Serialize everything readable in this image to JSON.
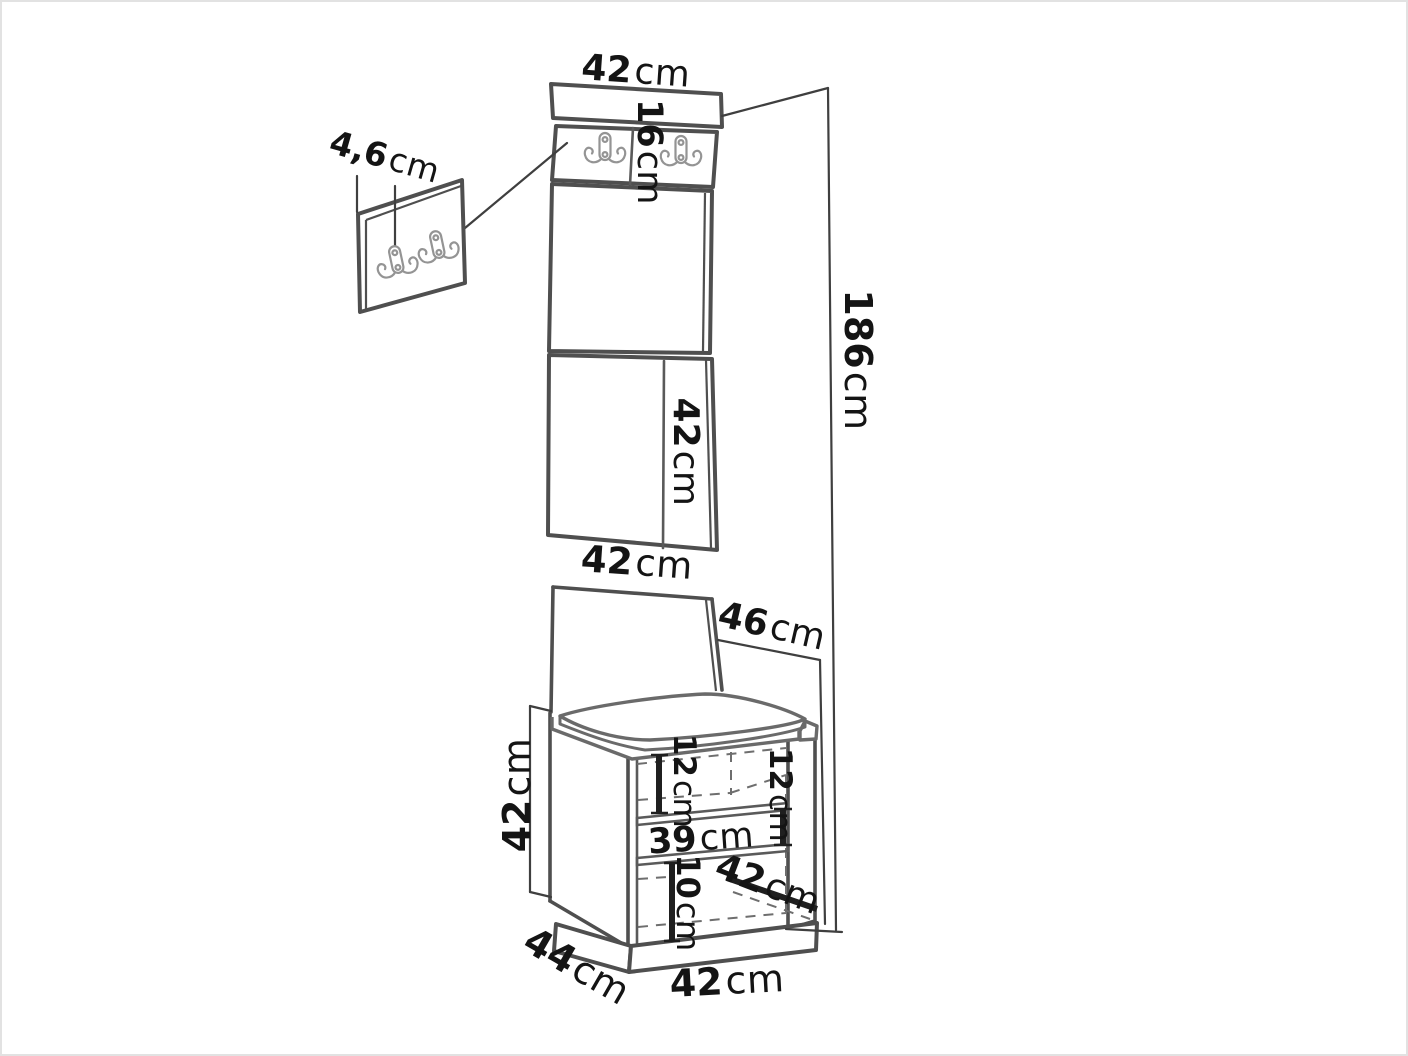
{
  "figure": {
    "kind": "furniture dimension line drawing",
    "icons": {
      "coat_hook": "double-coat-hook-icon"
    },
    "colors": {
      "background": "#ffffff",
      "line": "#4f4f4f",
      "dashed_line": "#6e6e6e",
      "hook_line": "#949494",
      "text": "#141414",
      "border": "#e2e2e2"
    }
  },
  "dimensions": {
    "top_width": {
      "value": "42",
      "unit": "cm"
    },
    "hook_strip_height": {
      "value": "16",
      "unit": "cm"
    },
    "hook_panel_thickness": {
      "value": "4,6",
      "unit": "cm"
    },
    "total_height": {
      "value": "186",
      "unit": "cm"
    },
    "panel_segment_height": {
      "value": "42",
      "unit": "cm"
    },
    "panel_width": {
      "value": "42",
      "unit": "cm"
    },
    "seat_depth": {
      "value": "46",
      "unit": "cm"
    },
    "bench_height": {
      "value": "42",
      "unit": "cm"
    },
    "opening_left_height": {
      "value": "12",
      "unit": "cm"
    },
    "opening_right_height": {
      "value": "12",
      "unit": "cm"
    },
    "opening_width": {
      "value": "39",
      "unit": "cm"
    },
    "lower_compartment_height": {
      "value": "10",
      "unit": "cm"
    },
    "bench_inner_depth": {
      "value": "42",
      "unit": "cm"
    },
    "bench_depth": {
      "value": "44",
      "unit": "cm"
    },
    "bench_width": {
      "value": "42",
      "unit": "cm"
    }
  }
}
